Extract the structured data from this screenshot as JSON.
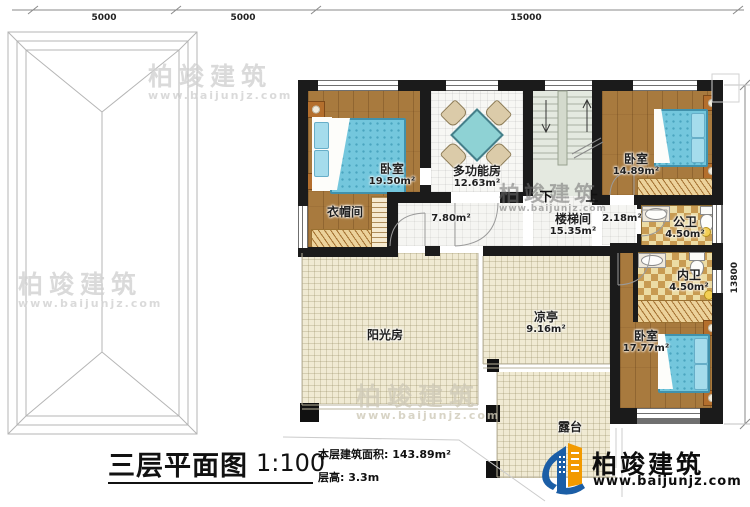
{
  "dimensions": {
    "top": [
      "5000",
      "5000",
      "15000"
    ],
    "right": "13800"
  },
  "rooms": {
    "bedroom1": {
      "name": "卧室",
      "area": "19.50m²"
    },
    "multifunction": {
      "name": "多功能房",
      "area": "12.63m²"
    },
    "cloakroom": {
      "name": "衣帽间"
    },
    "hallway": {
      "area": "7.80m²"
    },
    "stairwell": {
      "name": "楼梯间",
      "area": "15.35m²"
    },
    "landing": {
      "area": "2.18m²"
    },
    "bedroom2": {
      "name": "卧室",
      "area": "14.89m²"
    },
    "public_bath": {
      "name": "公卫",
      "area": "4.50m²"
    },
    "private_bath": {
      "name": "内卫",
      "area": "4.50m²"
    },
    "bedroom3": {
      "name": "卧室",
      "area": "17.77m²"
    },
    "sunroom": {
      "name": "阳光房"
    },
    "pavilion": {
      "name": "凉亭",
      "area": "9.16m²"
    },
    "terrace": {
      "name": "露台"
    }
  },
  "stairs": {
    "down": "下",
    "up": "上"
  },
  "title_block": {
    "title": "三层平面图",
    "scale": "1:100",
    "area_line": "本层建筑面积: 143.89m²",
    "height_line": "层高: 3.3m"
  },
  "brand": {
    "name": "柏竣建筑",
    "url": "www.baijunjz.com"
  },
  "watermark": {
    "name": "柏竣建筑",
    "url": "www.baijunjz.com"
  },
  "colors": {
    "wall": "#1b1b1b",
    "wood_floor": "#a87a3e",
    "bed_blue": "#74c7dd",
    "bath_tile": "#c89b52",
    "outdoor_cream": "#f0ead3",
    "brand_blue": "#1b5ea6",
    "brand_orange": "#f29a00"
  }
}
